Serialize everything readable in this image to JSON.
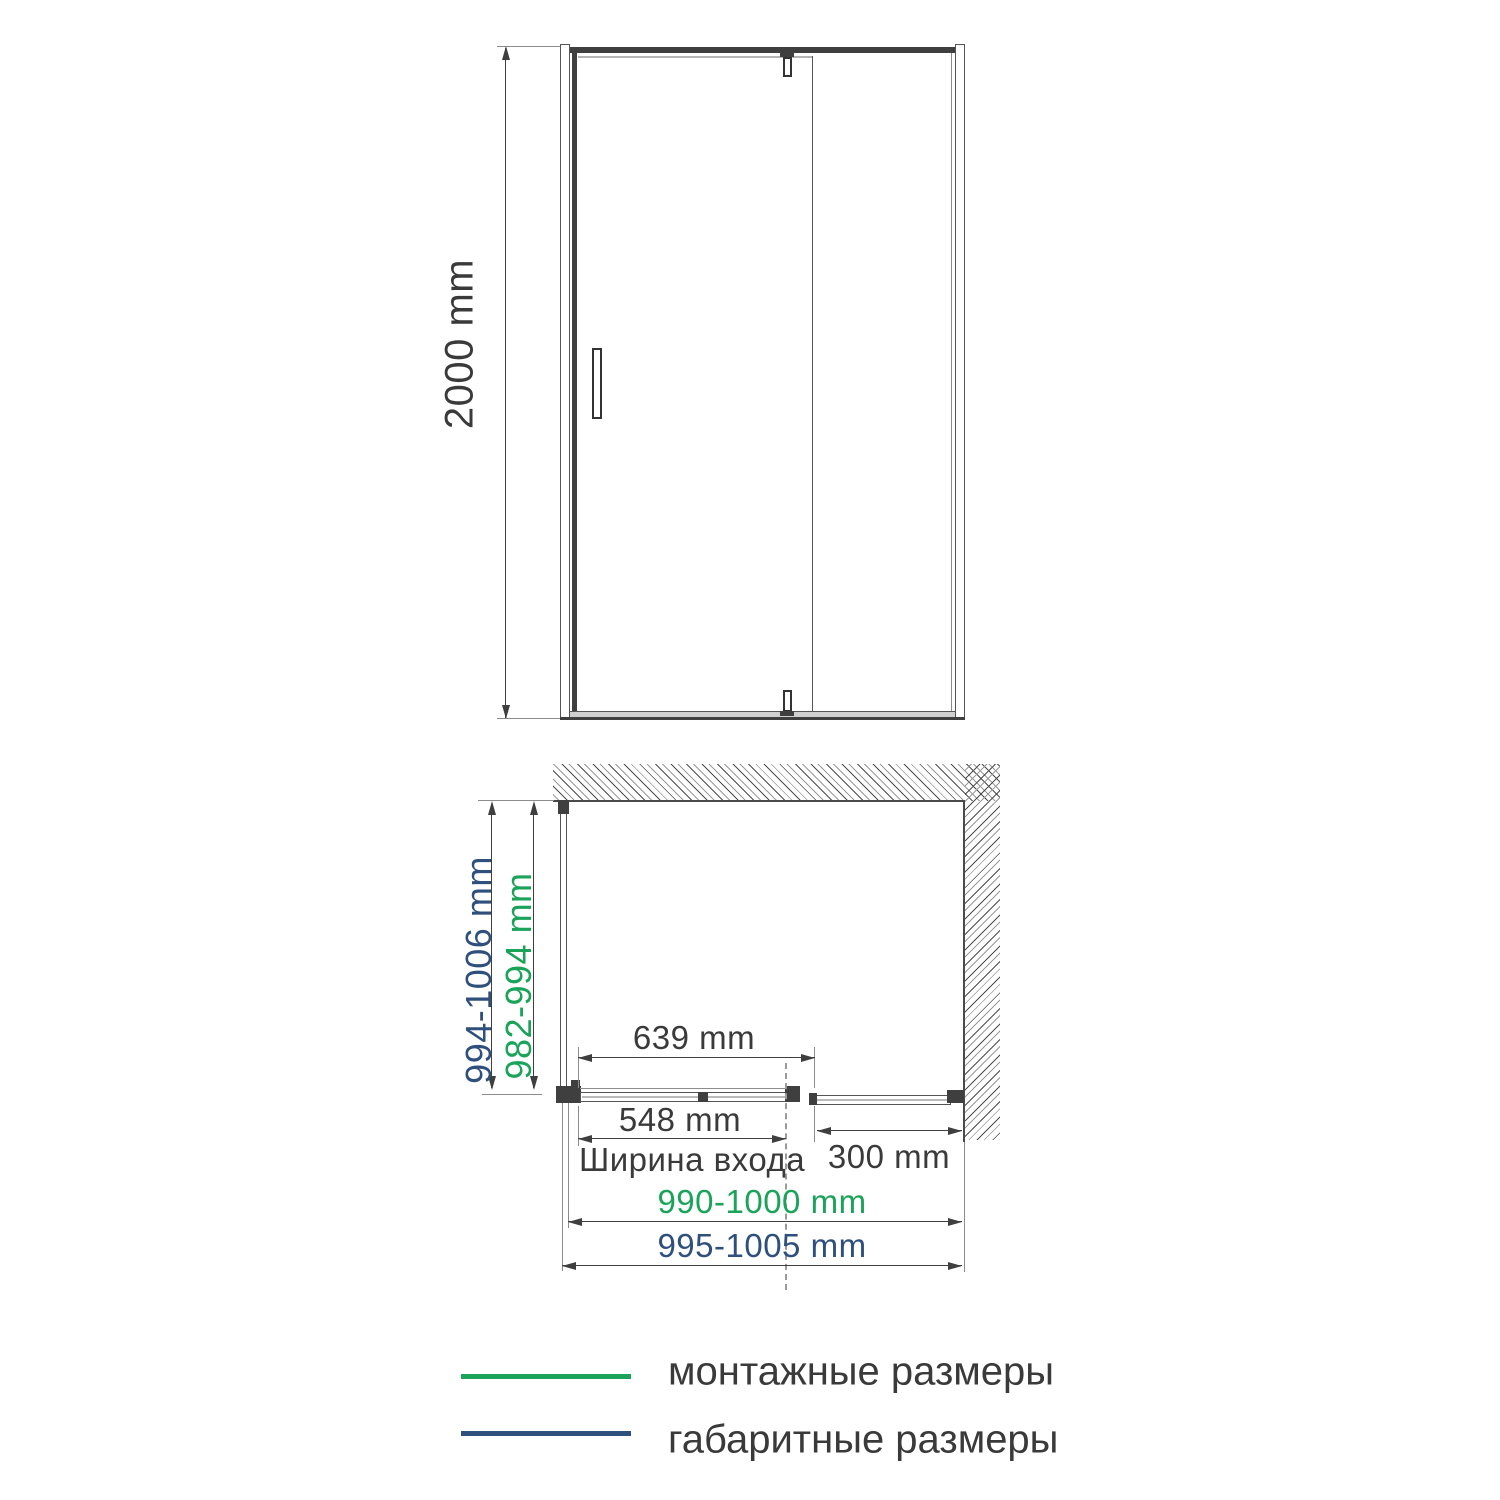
{
  "front_view": {
    "height_dim": "2000 mm"
  },
  "plan_view": {
    "overall_depth_dim": "994-1006 mm",
    "mount_depth_dim": "982-994 mm",
    "door_panel_dim": "639 mm",
    "entry_width_dim": "548 mm",
    "entry_width_caption": "Ширина входа",
    "fixed_panel_dim": "300 mm",
    "mount_width_dim": "990-1000 mm",
    "overall_width_dim": "995-1005 mm"
  },
  "legend": {
    "items": [
      {
        "label": "монтажные размеры",
        "swatch_color": "#1ba35a"
      },
      {
        "label": "габаритные размеры",
        "swatch_color": "#2f4f7d"
      }
    ]
  },
  "colors": {
    "mounting_green": "#1ba35a",
    "overall_navy": "#2f4f7d",
    "ink": "#3a3a3a"
  }
}
